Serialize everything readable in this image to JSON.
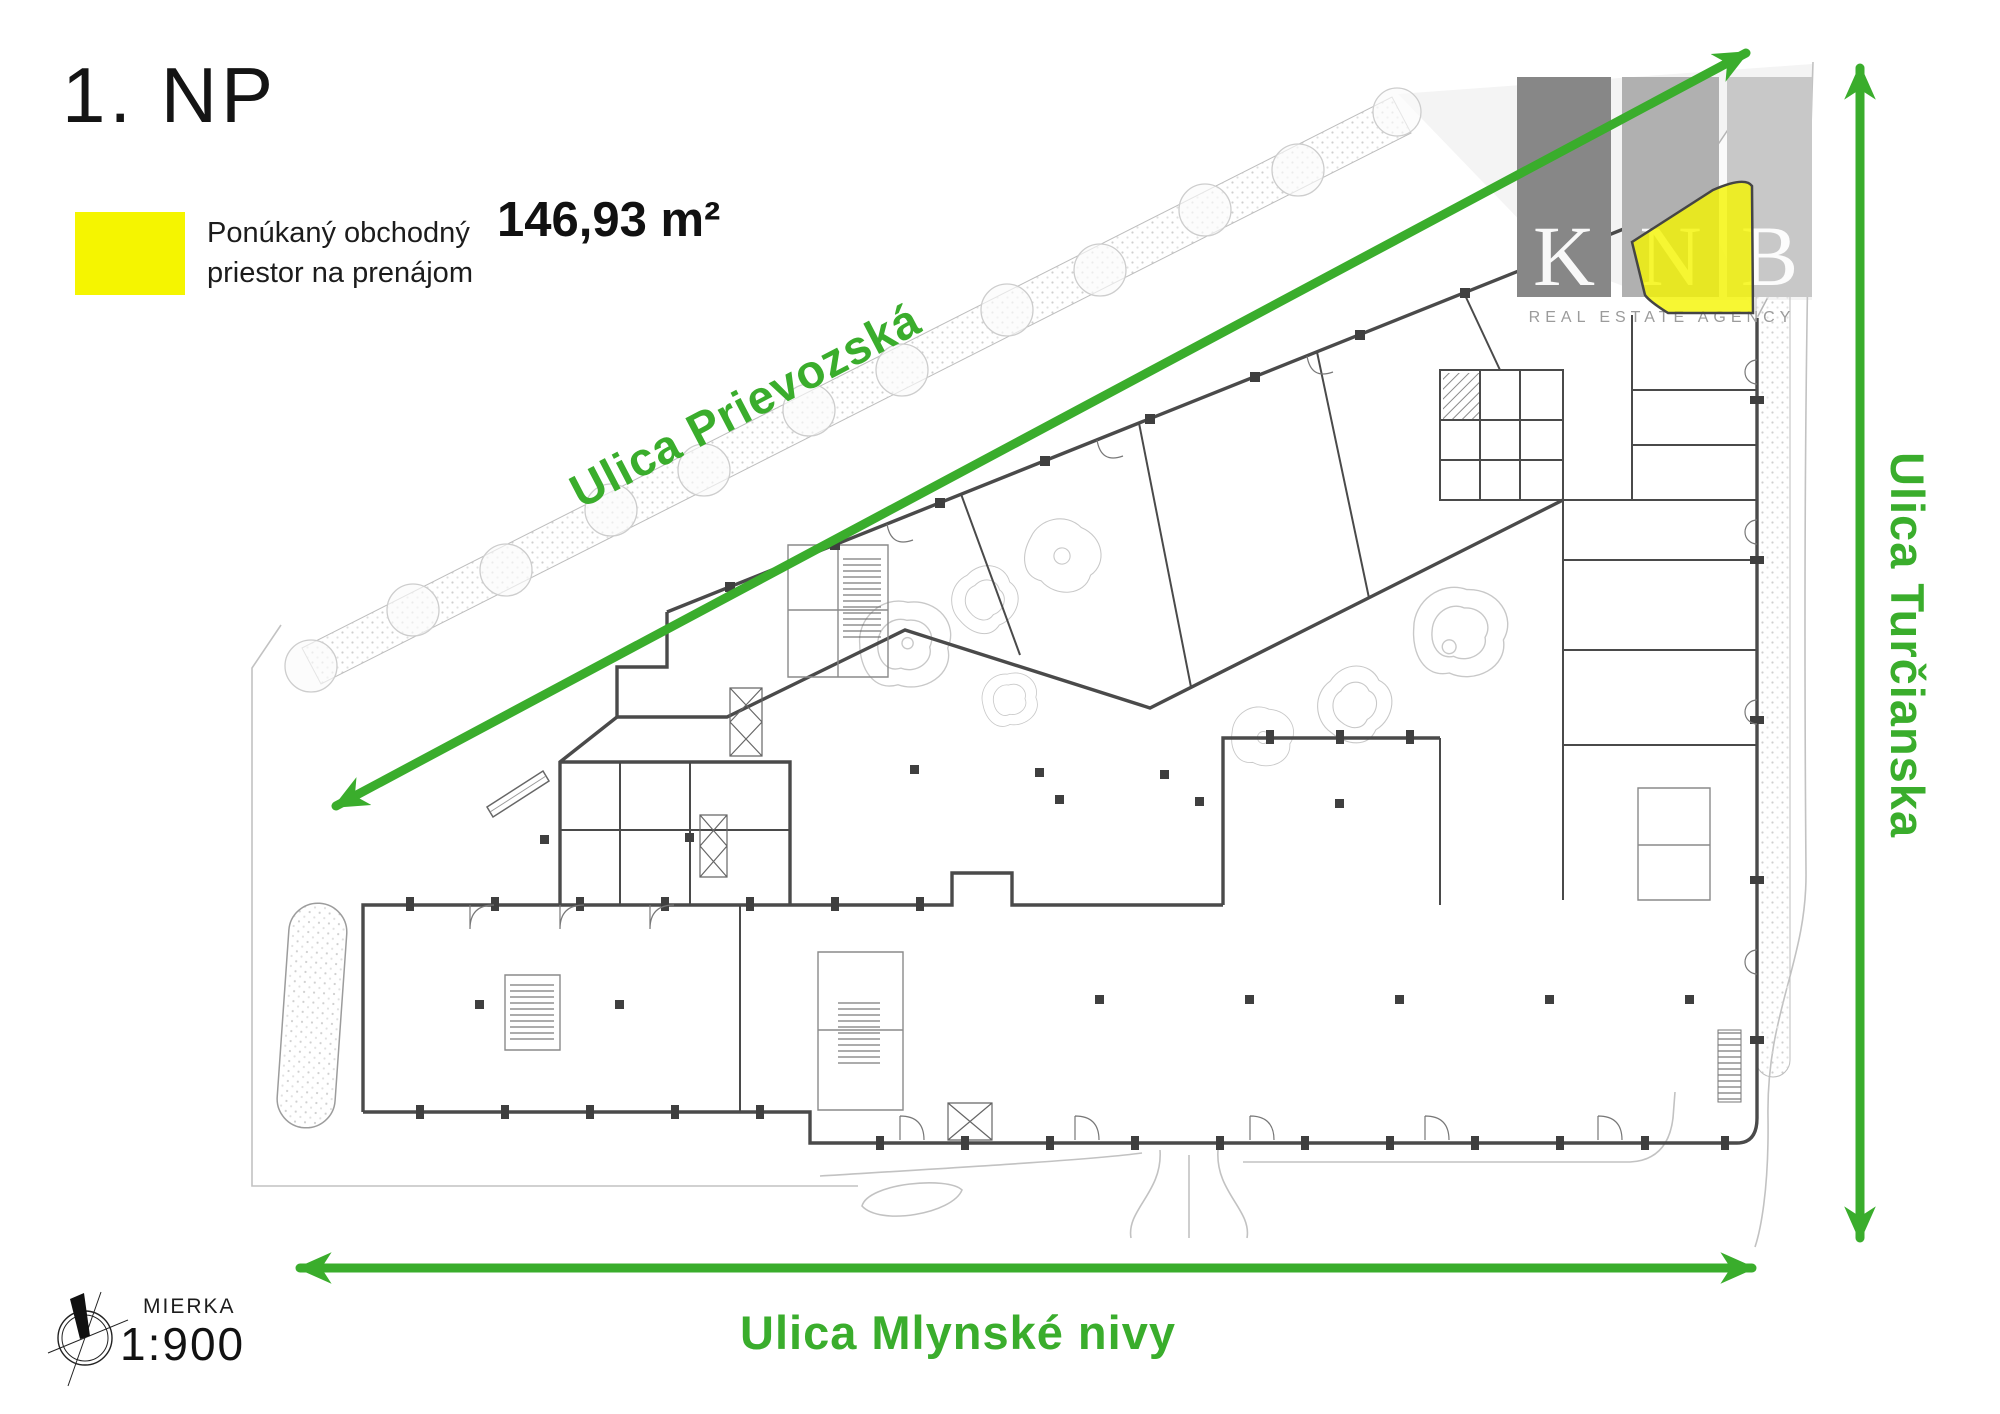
{
  "page": {
    "title": "1. NP"
  },
  "legend": {
    "label": "Ponúkaný obchodný priestor na prenájom",
    "area_value": "146,93 m²"
  },
  "streets": {
    "diagonal": "Ulica Prievozská",
    "right": "Ulica Turčianska",
    "bottom": "Ulica Mlynské nivy"
  },
  "scale": {
    "label": "MIERKA",
    "value": "1:900"
  },
  "watermark": {
    "letters": [
      "K",
      "N",
      "B"
    ],
    "subtitle": "REAL ESTATE AGENCY"
  },
  "colors": {
    "accent": "#3aad2c",
    "highlight": "#f5f500",
    "wm_dark": "#878787",
    "wm_mid": "#b0b0b0",
    "wm_light": "#c8c8c8"
  }
}
